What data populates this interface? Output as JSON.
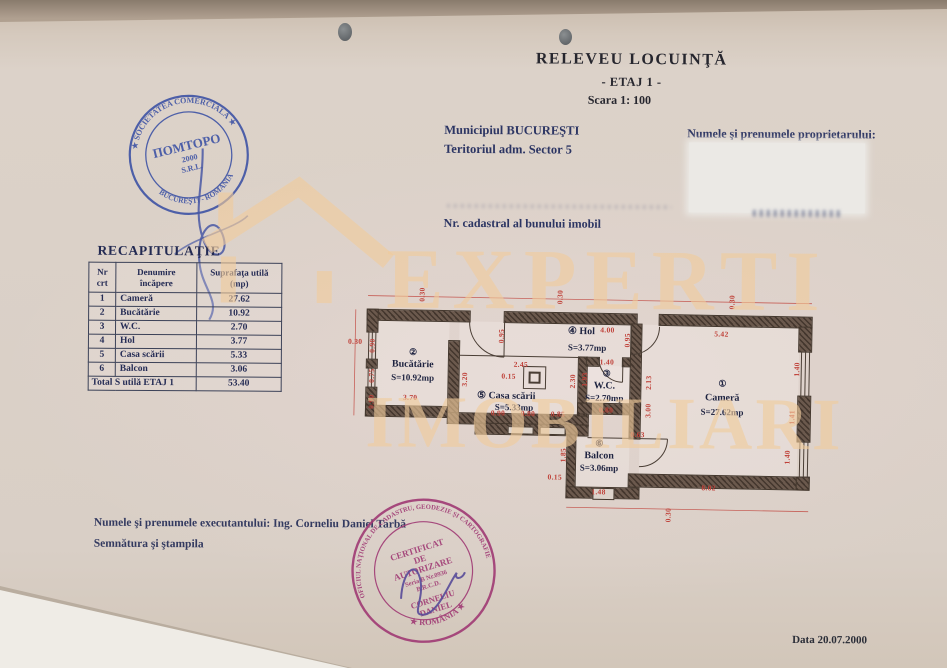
{
  "page": {
    "title": "RELEVEU  LOCUINŢĂ",
    "subtitle": "- ETAJ 1 -",
    "scale": "Scara  1: 100",
    "municipality_line1": "Municipiul BUCUREŞTI",
    "municipality_line2": "Teritoriul adm. Sector 5",
    "owner_label": "Numele şi prenumele proprietarului:",
    "cadastral_label": "Nr. cadastral al bunului imobil",
    "executor_line": "Numele şi prenumele executantului:  Ing.  Corneliu Daniel Tarbă",
    "signature_line": "Semnătura  şi ştampila",
    "date_label": "Data  20.07.2000"
  },
  "recap_table": {
    "title": "RECAPITULAŢIE",
    "headers": [
      "Nr\ncrt",
      "Denumire\nîncăpere",
      "Suprafaţa utilă\n(mp)"
    ],
    "rows": [
      [
        "1",
        "Cameră",
        "27.62"
      ],
      [
        "2",
        "Bucătărie",
        "10.92"
      ],
      [
        "3",
        "W.C.",
        "2.70"
      ],
      [
        "4",
        "Hol",
        "3.77"
      ],
      [
        "5",
        "Casa scării",
        "5.33"
      ],
      [
        "6",
        "Balcon",
        "3.06"
      ]
    ],
    "total_label": "Total S utilă  ETAJ 1",
    "total_value": "53.40"
  },
  "floor_plan": {
    "rooms": [
      {
        "lines": [
          "②",
          "Bucătărie",
          "S=10.92mp"
        ],
        "x": [
          64,
          64,
          64
        ],
        "y": [
          70,
          82,
          95
        ]
      },
      {
        "lines": [
          "④  Hol",
          "S=3.77mp"
        ],
        "x": [
          232,
          238
        ],
        "y": [
          46,
          62
        ]
      },
      {
        "lines": [
          "⑤  Casa scării",
          "S=5.33mp"
        ],
        "x": [
          158,
          166
        ],
        "y": [
          112,
          123
        ]
      },
      {
        "lines": [
          "③",
          "W.C.",
          "S=2.70mp"
        ],
        "x": [
          258,
          256,
          256
        ],
        "y": [
          88,
          100,
          112
        ]
      },
      {
        "lines": [
          "①",
          "Cameră",
          "S=27.62mp"
        ],
        "x": [
          374,
          374,
          374
        ],
        "y": [
          96,
          110,
          124
        ]
      },
      {
        "lines": [
          "⑥",
          "Balcon",
          "S=3.06mp"
        ],
        "x": [
          252,
          252,
          252
        ],
        "y": [
          158,
          170,
          182
        ]
      }
    ],
    "dimensions": [
      {
        "t": "0.30",
        "x": 72,
        "y": 12,
        "r": 1
      },
      {
        "t": "0.30",
        "x": 210,
        "y": 12,
        "r": 1
      },
      {
        "t": "0.30",
        "x": 382,
        "y": 14,
        "r": 1
      },
      {
        "t": "0.30",
        "x": 6,
        "y": 60,
        "r": 0
      },
      {
        "t": "4.00",
        "x": 258,
        "y": 44,
        "r": 0
      },
      {
        "t": "5.42",
        "x": 372,
        "y": 46,
        "r": 0
      },
      {
        "t": "0.90",
        "x": 23,
        "y": 64,
        "r": 1
      },
      {
        "t": "0.75",
        "x": 23,
        "y": 94,
        "r": 1
      },
      {
        "t": "0.90",
        "x": 23,
        "y": 120,
        "r": 1
      },
      {
        "t": "3.70",
        "x": 62,
        "y": 115,
        "r": 0
      },
      {
        "t": "0.95",
        "x": 152,
        "y": 52,
        "r": 1
      },
      {
        "t": "2.45",
        "x": 172,
        "y": 80,
        "r": 0
      },
      {
        "t": "0.15",
        "x": 160,
        "y": 92,
        "r": 0
      },
      {
        "t": "3.20",
        "x": 116,
        "y": 96,
        "r": 1
      },
      {
        "t": "2.30",
        "x": 224,
        "y": 96,
        "r": 1
      },
      {
        "t": "0.90",
        "x": 150,
        "y": 129,
        "r": 0
      },
      {
        "t": "0.80",
        "x": 180,
        "y": 129,
        "r": 0
      },
      {
        "t": "0.85",
        "x": 210,
        "y": 129,
        "r": 0
      },
      {
        "t": "0.95",
        "x": 278,
        "y": 54,
        "r": 1
      },
      {
        "t": "1.40",
        "x": 258,
        "y": 76,
        "r": 0
      },
      {
        "t": "1.93",
        "x": 236,
        "y": 94,
        "r": 1
      },
      {
        "t": "0.80",
        "x": 258,
        "y": 124,
        "r": 0
      },
      {
        "t": "2.13",
        "x": 300,
        "y": 96,
        "r": 1
      },
      {
        "t": "3.00",
        "x": 300,
        "y": 124,
        "r": 1
      },
      {
        "t": "0.63",
        "x": 290,
        "y": 148,
        "r": 0
      },
      {
        "t": "1.85",
        "x": 216,
        "y": 170,
        "r": 1
      },
      {
        "t": "0.15",
        "x": 208,
        "y": 192,
        "r": 0
      },
      {
        "t": "1.48",
        "x": 252,
        "y": 206,
        "r": 0
      },
      {
        "t": "8.02",
        "x": 362,
        "y": 200,
        "r": 0
      },
      {
        "t": "1.40",
        "x": 448,
        "y": 80,
        "r": 1
      },
      {
        "t": "1.41",
        "x": 444,
        "y": 128,
        "r": 1
      },
      {
        "t": "1.40",
        "x": 440,
        "y": 168,
        "r": 1
      },
      {
        "t": "0.30",
        "x": 322,
        "y": 228,
        "r": 1
      }
    ]
  },
  "watermark": {
    "line1": "EXPERTI",
    "line2": "IMOBILIARI"
  },
  "stamps": {
    "blue": {
      "ring_top": "★ SOCIETATEA  COMERCIALĂ ★",
      "ring_bottom": "BUCUREŞTI - ROMÂNIA",
      "center1": "ПОМТОРО",
      "center2": "2000",
      "center3": "S.R.L."
    },
    "purple": {
      "ring_top": "OFICIUL NAŢIONAL DE CADASTRU, GEODEZIE ŞI CARTOGRAFIE",
      "ring_bottom": "★ ROMÂNIA ★",
      "cert1": "CERTIFICAT",
      "cert2": "DE",
      "cert3": "AUTORIZARE",
      "seria": "Seria B Nr.0936",
      "brcd": "B.R.C.D.",
      "name1": "CORNELIU",
      "name2": "DANIEL"
    }
  },
  "colors": {
    "ink_blue": "#2c3563",
    "dim_red": "#bf4038",
    "wall": "#6b594d",
    "stamp_blue": "#3a50a4",
    "stamp_purple": "#a03a74",
    "watermark": "#f1cc9c"
  }
}
